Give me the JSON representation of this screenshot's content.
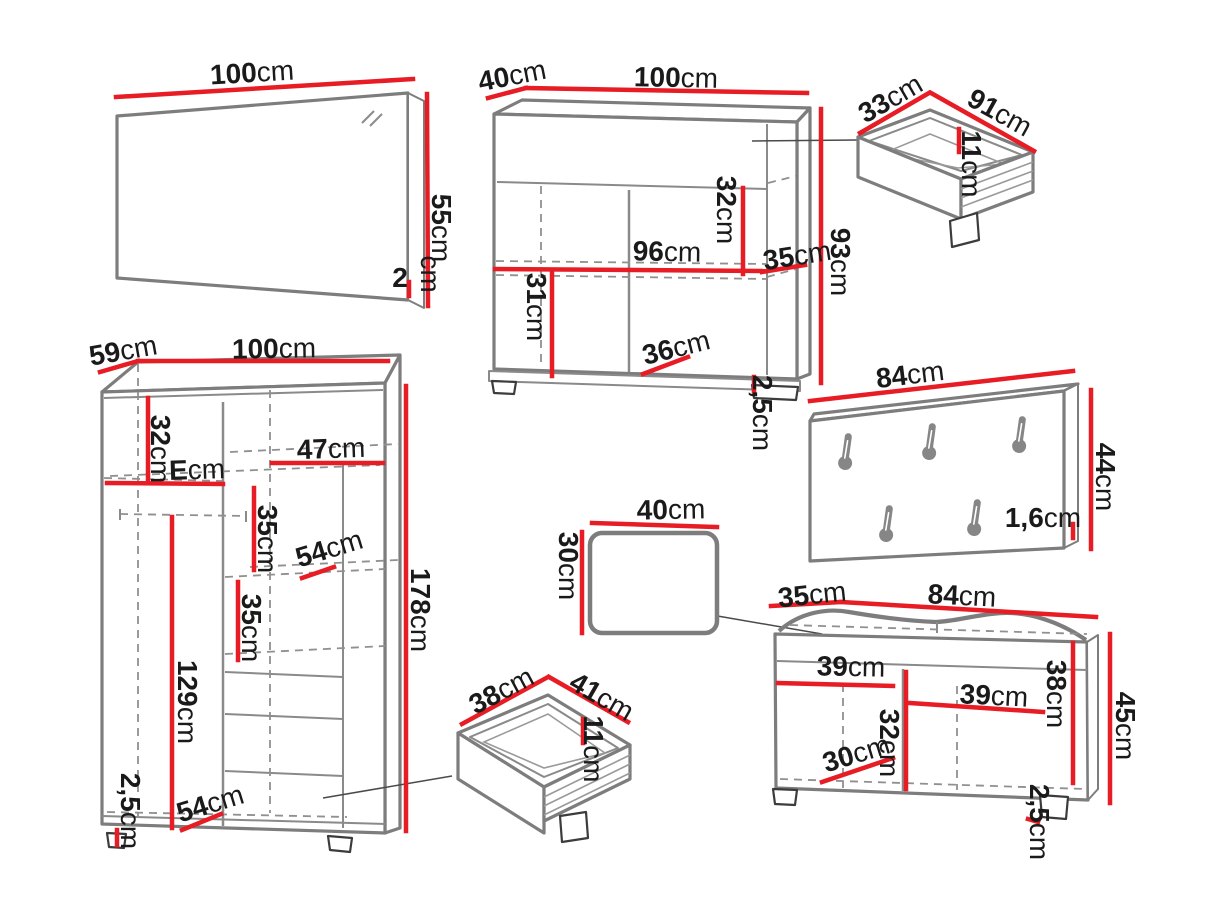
{
  "diagram_type": "furniture-dimension-diagram",
  "unit": "cm",
  "colors": {
    "dimension_line": "#e81c24",
    "outline": "#7d7d7d",
    "text": "#1a1a1a"
  },
  "mirror": {
    "width": {
      "v": "100",
      "u": "cm"
    },
    "height": {
      "v": "55",
      "u": "cm"
    },
    "depth": {
      "v": "2",
      "u": "cm"
    }
  },
  "chest": {
    "depth": {
      "v": "40",
      "u": "cm"
    },
    "width": {
      "v": "100",
      "u": "cm"
    },
    "height": {
      "v": "93",
      "u": "cm"
    },
    "inner_width": {
      "v": "96",
      "u": "cm"
    },
    "upper_inner_height": {
      "v": "32",
      "u": "cm"
    },
    "shelf_depth": {
      "v": "35",
      "u": "cm"
    },
    "lower_inner_height": {
      "v": "31",
      "u": "cm"
    },
    "lower_inner_width": {
      "v": "36",
      "u": "cm"
    },
    "plinth_height": {
      "v": "2,5",
      "u": "cm"
    }
  },
  "drawer_top": {
    "depth": {
      "v": "33",
      "u": "cm"
    },
    "width": {
      "v": "91",
      "u": "cm"
    },
    "height": {
      "v": "11",
      "u": "cm"
    }
  },
  "coat_rack": {
    "width": {
      "v": "84",
      "u": "cm"
    },
    "height": {
      "v": "44",
      "u": "cm"
    },
    "thickness": {
      "v": "1,6",
      "u": "cm"
    },
    "hook_count": 5
  },
  "wardrobe": {
    "depth": {
      "v": "59",
      "u": "cm"
    },
    "width": {
      "v": "100",
      "u": "cm"
    },
    "height": {
      "v": "178",
      "u": "cm"
    },
    "upper_left_height": {
      "v": "32",
      "u": "cm"
    },
    "left_shelf_width": {
      "v": "E",
      "u": "cm"
    },
    "right_shelf_width": {
      "v": "47",
      "u": "cm"
    },
    "middle_gap": {
      "v": "35",
      "u": "cm"
    },
    "shelf_depth": {
      "v": "54",
      "u": "cm"
    },
    "lower_gap": {
      "v": "35",
      "u": "cm"
    },
    "left_section_height": {
      "v": "129",
      "u": "cm"
    },
    "plinth_height": {
      "v": "2,5",
      "u": "cm"
    },
    "bottom_shelf_width": {
      "v": "54",
      "u": "cm"
    }
  },
  "stool": {
    "width": {
      "v": "40",
      "u": "cm"
    },
    "depth": {
      "v": "30",
      "u": "cm"
    }
  },
  "drawer_bottom": {
    "depth": {
      "v": "38",
      "u": "cm"
    },
    "width": {
      "v": "41",
      "u": "cm"
    },
    "height": {
      "v": "11",
      "u": "cm"
    }
  },
  "bench": {
    "depth": {
      "v": "35",
      "u": "cm"
    },
    "width": {
      "v": "84",
      "u": "cm"
    },
    "height": {
      "v": "45",
      "u": "cm"
    },
    "inner_height": {
      "v": "38",
      "u": "cm"
    },
    "left_compartment_width": {
      "v": "39",
      "u": "cm"
    },
    "right_compartment_width": {
      "v": "39",
      "u": "cm"
    },
    "center_inner_height": {
      "v": "32",
      "u": "cm"
    },
    "inner_depth": {
      "v": "30",
      "u": "cm"
    },
    "plinth_height": {
      "v": "2,5",
      "u": "cm"
    }
  }
}
